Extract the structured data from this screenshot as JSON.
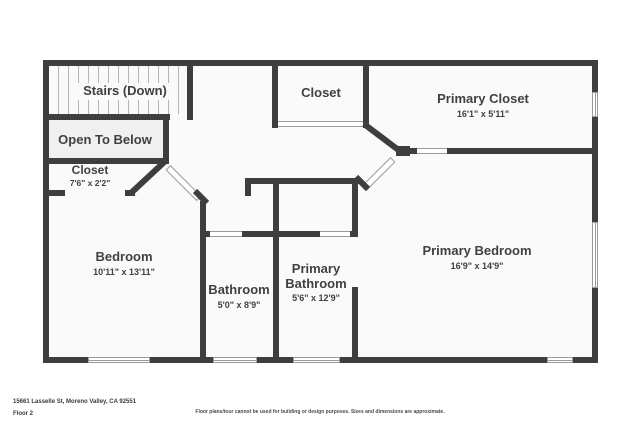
{
  "rooms": {
    "stairs": {
      "name": "Stairs (Down)"
    },
    "open_to_below": {
      "name": "Open To Below"
    },
    "closet_left": {
      "name": "Closet",
      "dims": "7'6\" x 2'2\""
    },
    "closet_top": {
      "name": "Closet"
    },
    "primary_closet": {
      "name": "Primary Closet",
      "dims": "16'1\" x 5'11\""
    },
    "bedroom": {
      "name": "Bedroom",
      "dims": "10'11\" x 13'11\""
    },
    "bathroom": {
      "name": "Bathroom",
      "dims": "5'0\" x 8'9\""
    },
    "primary_bathroom": {
      "name": "Primary Bathroom",
      "dims": "5'6\" x 12'9\""
    },
    "primary_bedroom": {
      "name": "Primary Bedroom",
      "dims": "16'9\" x 14'9\""
    }
  },
  "footer": {
    "address": "15661 Lasselle St, Moreno Valley, CA 92551",
    "floor_label": "Floor 2",
    "disclaimer": "Floor plans/tour cannot be used for building or design purposes. Sizes and dimensions are approximate."
  },
  "colors": {
    "wall": "#3e3e3e",
    "room_fill": "#fafafa",
    "open_below_fill": "#f0f0f0",
    "window_frame": "#9a9a9a",
    "label_text": "#3f3f46"
  }
}
